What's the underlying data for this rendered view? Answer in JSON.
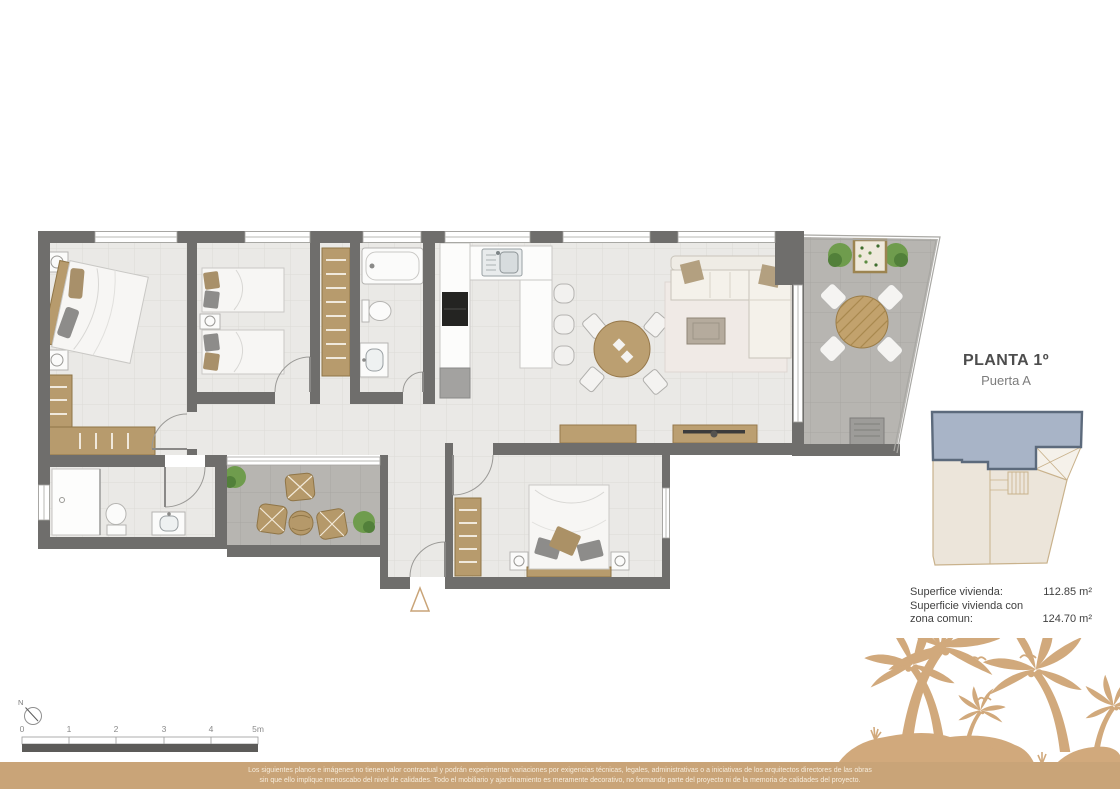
{
  "key_plan_panel": {
    "title": "PLANTA 1º",
    "subtitle": "Puerta A"
  },
  "areas": {
    "row1_label": "Superfice vivienda:",
    "row1_value": "112.85 m²",
    "row2_label_line1": "Superficie vivienda con",
    "row2_label_line2": "zona comun:",
    "row2_value": "124.70 m²"
  },
  "compass": {
    "north_label": "N"
  },
  "scale_bar": {
    "labels": [
      "0",
      "1",
      "2",
      "3",
      "4",
      "5m"
    ]
  },
  "disclaimer": {
    "line1": "Los siguientes planos e imágenes no tienen valor contractual y podrán experimentar variaciones por exigencias técnicas, legales, administrativas o a iniciativas de los arquitectos directores de las obras",
    "line2": "sin que ello implique menoscabo del nivel de calidades. Todo el mobiliario y ajardinamiento es meramente decorativo, no formando parte del proyecto ni de la memoria de calidades del proyecto."
  },
  "colors": {
    "accent_gold": "#c9a478",
    "palm_silhouette": "#d1a97c",
    "wall_gray": "#6f6e6c",
    "floor_light": "#eae9e6",
    "floor_terrace": "#b7b5b1",
    "key_plan_highlight": "#a8b4c7",
    "key_plan_neutral": "#ece5da",
    "wood_furniture": "#b79b6d"
  }
}
